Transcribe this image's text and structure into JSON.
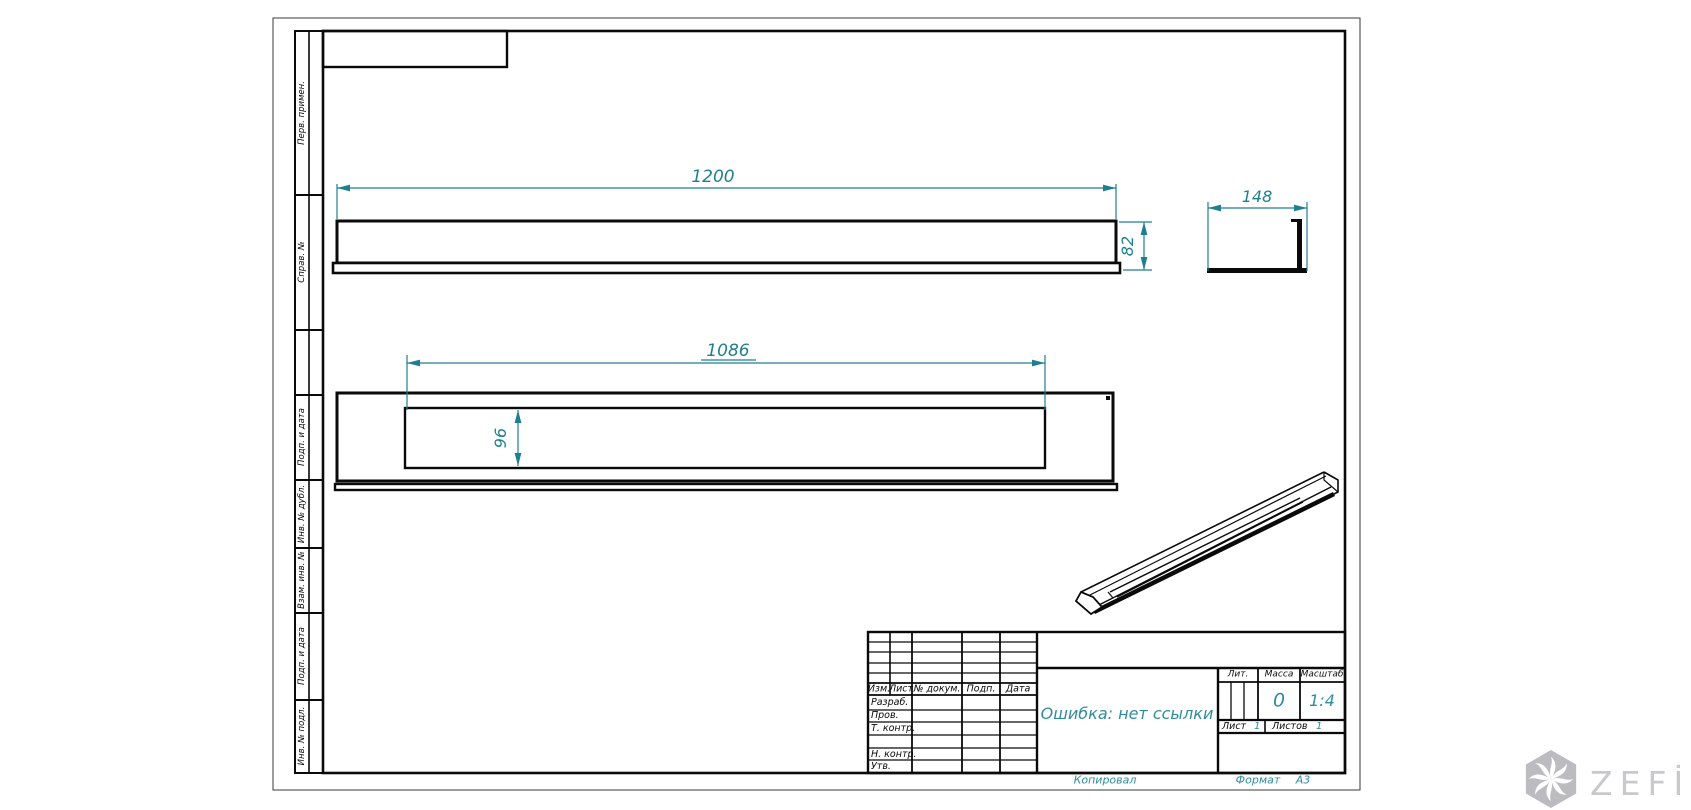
{
  "colors": {
    "accent": "#1e7f8e",
    "accent_light": "#2f8d9b",
    "line": "#0a0a0a",
    "watermark_gray": "#bcbcc0"
  },
  "sheet": {
    "format_label": "Формат",
    "format_value": "А3",
    "copied_label": "Копировал"
  },
  "chart_note": "GOST technical drawing of channel profile, scale 1:4",
  "dimensions": {
    "overall_length": "1200",
    "profile_height": "82",
    "profile_width": "148",
    "slot_length": "1086",
    "slot_width": "96"
  },
  "margin_labels": {
    "perv_primen": "Перв. примен.",
    "sprav_no": "Справ. №",
    "podp_i_data_1": "Подп. и дата",
    "inv_no_dubl": "Инв. № дубл.",
    "vzam_inv_no": "Взам. инв. №",
    "podp_i_data_2": "Подп. и дата",
    "inv_no_podl": "Инв. № подл."
  },
  "title_block": {
    "rev_header": {
      "izm": "Изм.",
      "list": "Лист",
      "doc": "№ докум.",
      "podp": "Подп.",
      "data": "Дата"
    },
    "sig_rows": {
      "r1": "Разраб.",
      "r2": "Пров.",
      "r3": "Т. контр.",
      "r4": "",
      "r5": "Н. контр.",
      "r6": "Утв."
    },
    "name_value": "Ошибка: нет ссылки",
    "lit_label": "Лит.",
    "mass_label": "Масса",
    "scale_label": "Масштаб",
    "mass_value": "0",
    "scale_value": "1:4",
    "sheet_label": "Лист",
    "sheet_value": "1",
    "sheets_label": "Листов",
    "sheets_value": "1"
  },
  "watermark": {
    "brand": "ZEFİRE",
    "logo": "hexagon-pinwheel-icon"
  }
}
